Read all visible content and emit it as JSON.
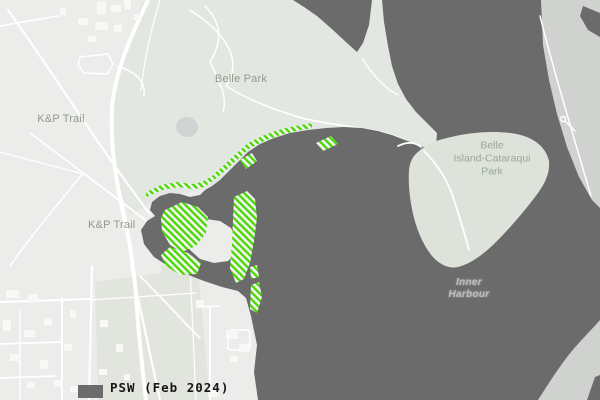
{
  "map": {
    "place_labels": {
      "kp_trail_upper": "K&P Trail",
      "kp_trail_lower": "K&P Trail",
      "belle_park": "Belle Park",
      "belle_island_park": {
        "line1": "Belle",
        "line2": "Island-Cataraqui",
        "line3": "Park"
      },
      "inner_harbour": {
        "line1": "Inner",
        "line2": "Harbour"
      }
    },
    "legend": {
      "label": "PSW (Feb 2024)"
    },
    "colors": {
      "water": "#6b6b6b",
      "land": "#ecedeb",
      "park": "#e3e7e1",
      "field": "#e1e5de",
      "island": "#dde2da",
      "farshore": "#cfd2ce",
      "road": "#ffffff",
      "building": "#f8f9f7",
      "psw": "#47d800",
      "pond": "#cdd4d3",
      "label_green": "#8f9b8a",
      "label_island": "#9aa89c",
      "label_water": "#bcbec0",
      "legend_text": "#161616"
    }
  }
}
